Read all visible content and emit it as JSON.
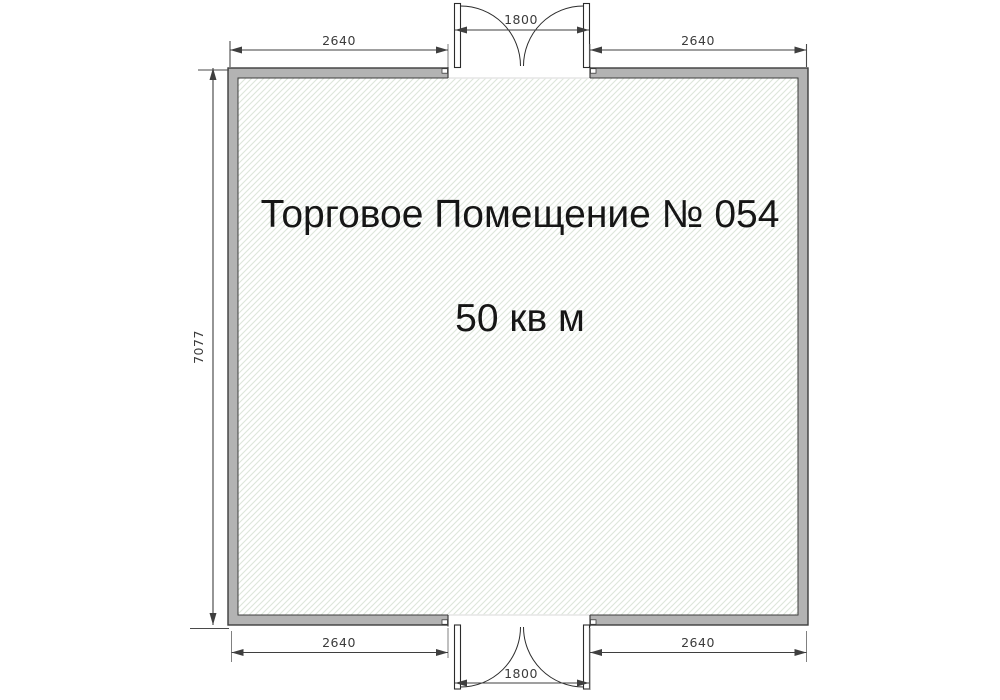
{
  "plan": {
    "title": "Торговое Помещение № 054",
    "area": "50 кв м",
    "dims": {
      "top_left": "2640",
      "top_door": "1800",
      "top_right": "2640",
      "left_height": "7077",
      "bottom_left": "2640",
      "bottom_door": "1800",
      "bottom_right": "2640"
    },
    "colors": {
      "wall_fill": "#b3b3b3",
      "wall_outline": "#3d3d3d",
      "hatch_line": "#dde6da",
      "dimension": "#3b3b3b",
      "extension": "#808080",
      "label_text": "#161616"
    }
  }
}
